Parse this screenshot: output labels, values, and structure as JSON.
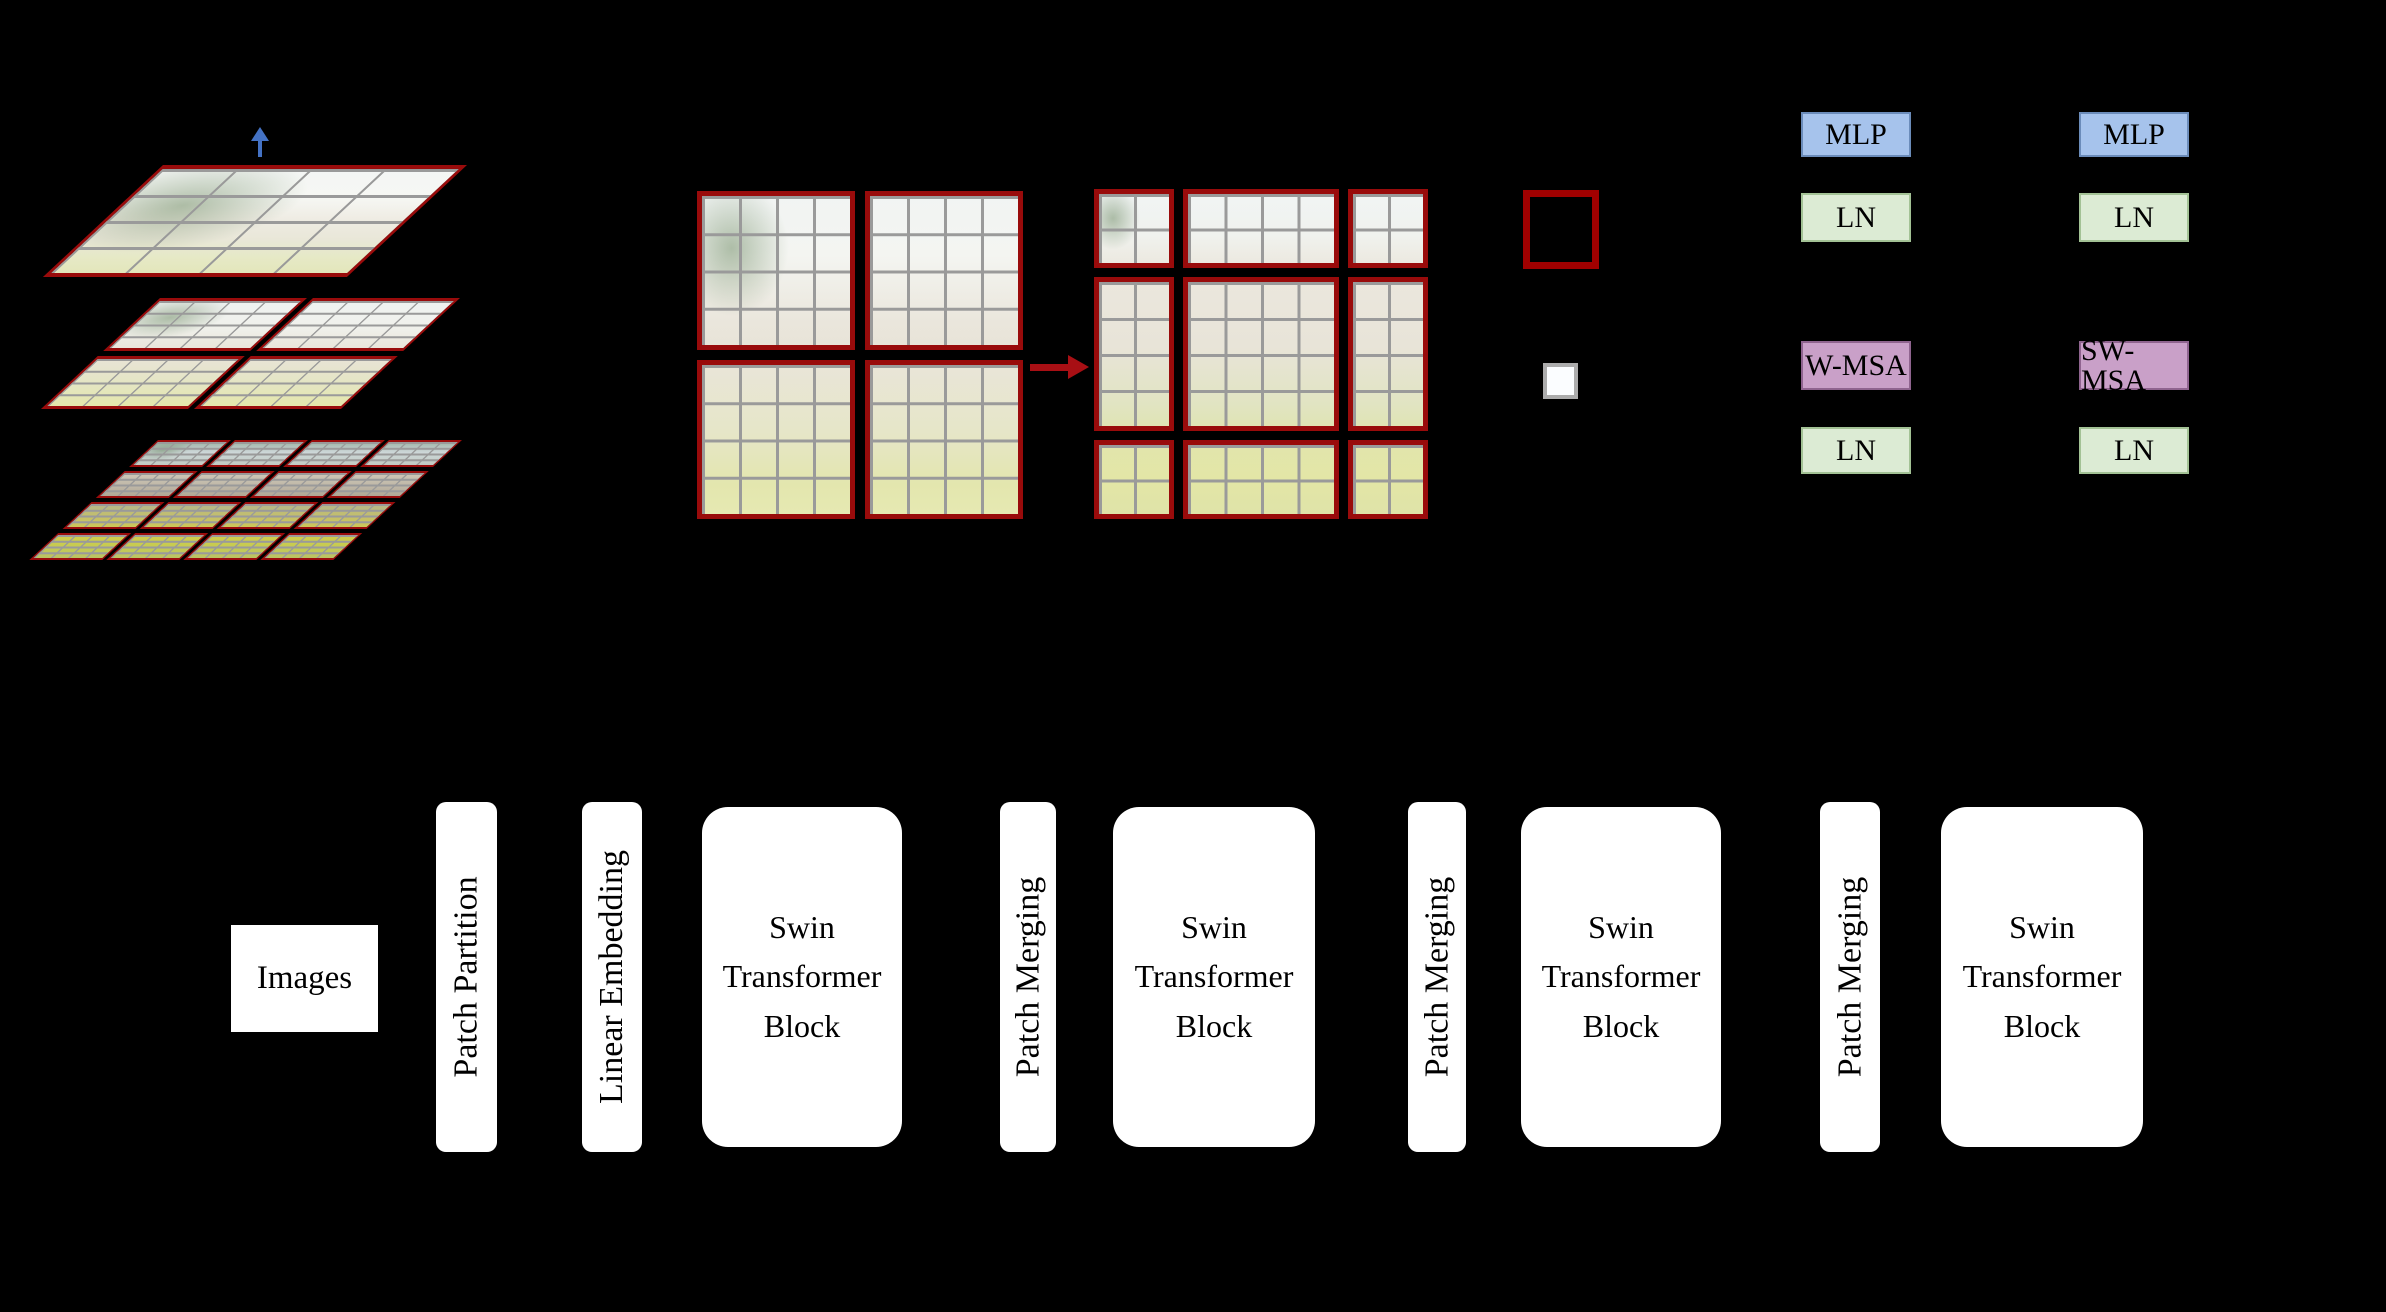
{
  "figure": {
    "hierarchy": {
      "description": "three stacked feature-map layers",
      "layers": [
        {
          "windows": "4x4 grid, 1 window"
        },
        {
          "windows": "2x2 windows of 4x4 patches"
        },
        {
          "windows": "4x4 windows of 4x4 patches"
        }
      ]
    },
    "window_shift": {
      "left": "2x2 window partition",
      "right": "3x3 shifted window partition"
    }
  },
  "transformer_blocks": {
    "left_column": [
      "MLP",
      "LN",
      "W-MSA",
      "LN"
    ],
    "right_column": [
      "MLP",
      "LN",
      "SW-MSA",
      "LN"
    ]
  },
  "pipeline": {
    "images_label": "Images",
    "stages": [
      {
        "label": "Patch Partition",
        "shape": "bar"
      },
      {
        "label": "Linear Embedding",
        "shape": "bar"
      },
      {
        "label": "Swin Transformer Block",
        "shape": "block"
      },
      {
        "label": "Patch Merging",
        "shape": "bar"
      },
      {
        "label": "Swin Transformer Block",
        "shape": "block"
      },
      {
        "label": "Patch Merging",
        "shape": "bar"
      },
      {
        "label": "Swin Transformer Block",
        "shape": "block"
      },
      {
        "label": "Patch Merging",
        "shape": "bar"
      },
      {
        "label": "Swin Transformer Block",
        "shape": "block"
      }
    ]
  },
  "colors": {
    "background": "#000000",
    "mlp_fill": "#a6c3ec",
    "ln_fill": "#dcebd4",
    "msa_fill": "#c9a0c8",
    "window_border_red": "#990b0b",
    "legend_red": "#a00000",
    "legend_patch_border": "#acacac",
    "arrow_red": "#a80f14",
    "arrow_blue": "#4472c4",
    "grid_line_gray": "#9a9a9a",
    "pipeline_box_fill": "#ffffff",
    "text": "#000000"
  }
}
